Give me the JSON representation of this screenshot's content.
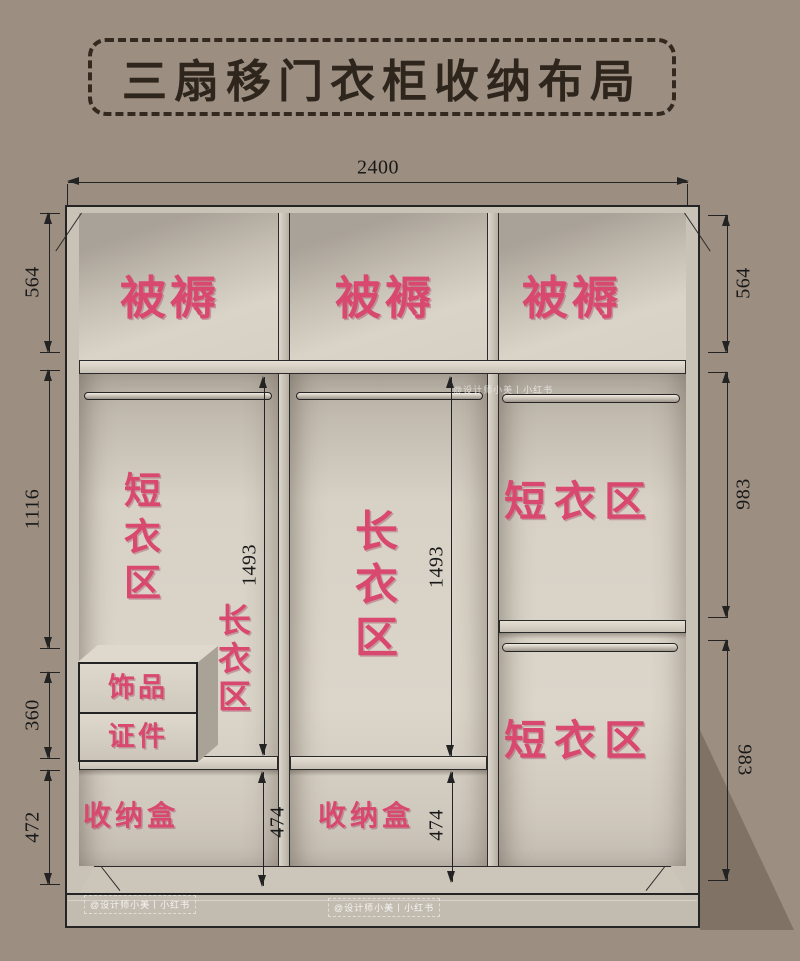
{
  "title": "三扇移门衣柜收纳布局",
  "wardrobe": {
    "dims": {
      "top_width": "2400",
      "left_top": "564",
      "left_mid": "1116",
      "left_drawer": "360",
      "left_bottom": "472",
      "right_top": "564",
      "right_mid": "983",
      "right_bottom": "983",
      "hang_left": "1493",
      "hang_mid": "1493",
      "box_left": "474",
      "box_mid": "474"
    },
    "zones": {
      "bedding": "被褥",
      "short_clothes": "短衣区",
      "long_clothes": "长衣区",
      "accessories": "饰品",
      "documents": "证件",
      "storage_box": "收纳盒"
    }
  },
  "watermark": "@设计师小美丨小红书",
  "colors": {
    "background": "#9c8e80",
    "label_pink": "#d8486f",
    "line": "#232323",
    "panel_light": "#dbd5ca"
  }
}
